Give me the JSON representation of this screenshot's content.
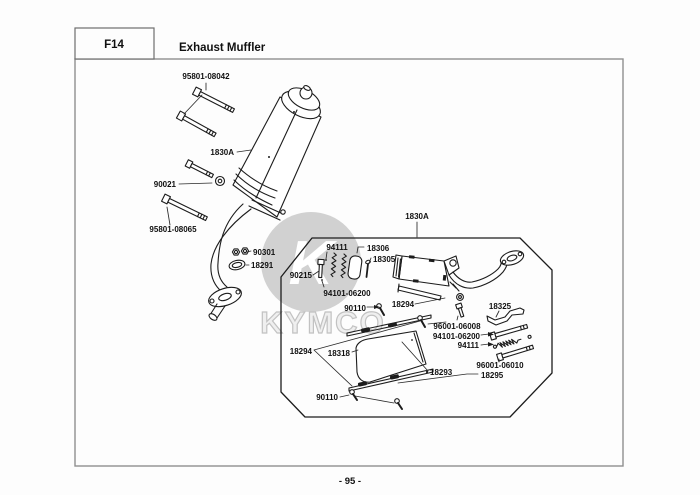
{
  "header": {
    "section_code": "F14",
    "title": "Exhaust Muffler"
  },
  "footer": {
    "page_number": "- 95 -"
  },
  "watermark": {
    "brand": "KYMCO",
    "emblem_letter": "K"
  },
  "colors": {
    "line_art": "#1c1c1c",
    "frame_gray": "#8f8f8f",
    "watermark_gray": "#c9c9c9"
  },
  "diagram": {
    "callout_labels": [
      "95801-08042",
      "1830A",
      "90021",
      "95801-08065",
      "90301",
      "18291",
      "1830A",
      "94111",
      "18306",
      "18305",
      "90215",
      "94101-06200",
      "18294",
      "90110",
      "18325",
      "96001-06008",
      "94101-06200",
      "94111",
      "18294",
      "18318",
      "18293",
      "96001-06010",
      "18295",
      "90110"
    ]
  }
}
